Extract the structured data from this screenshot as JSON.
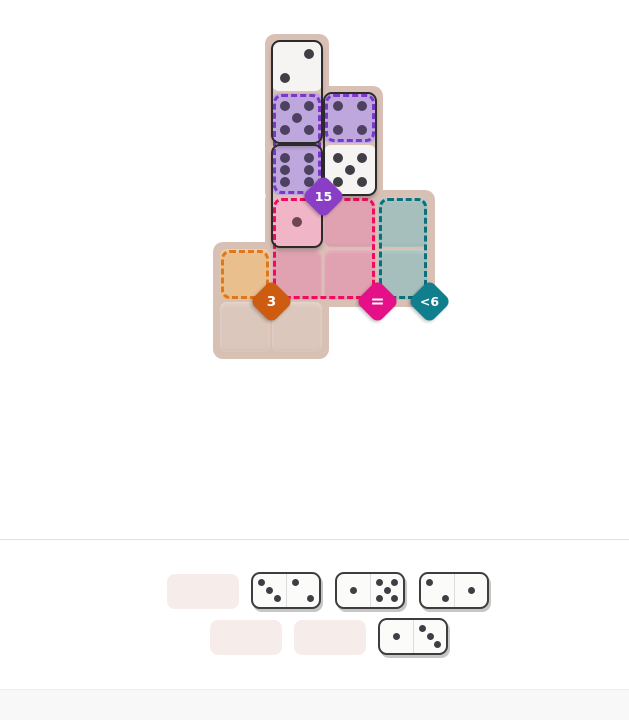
{
  "page": {
    "background": "#ffffff",
    "divider_color": "#e0e0e0",
    "footer_color": "#f8f8f8"
  },
  "palette": {
    "board_bg": "#d8c0b5",
    "cell_free": "#dbc7bc",
    "cell_white": "#f5f4f2",
    "cell_purple": "#bda7dc",
    "cell_pink_filled": "#f0b6c7",
    "cell_pink": "#e0a1b0",
    "cell_teal": "#a6bfbc",
    "cell_orange": "#eabf8e",
    "pip_dark": "#3f3e45",
    "pip_purple": "#4d4060",
    "pip_pink": "#6d4553",
    "domino_outline": "#2b2b2b",
    "tray_slot": "#f6edea",
    "tray_domino_bg": "#fbfbfa"
  },
  "constraints": [
    {
      "id": "sum-15",
      "label": "15",
      "color": "#8a3ec6",
      "border": "#7c36c9",
      "anchor": {
        "gx": 2,
        "gy": 3
      }
    },
    {
      "id": "sum-3",
      "label": "3",
      "color": "#cd5c10",
      "border": "#e1761a",
      "anchor": {
        "gx": 1,
        "gy": 5
      }
    },
    {
      "id": "all-equal",
      "label": "=",
      "color": "#e50f87",
      "border": "#f20a5e",
      "anchor": {
        "gx": 3,
        "gy": 5
      }
    },
    {
      "id": "less-than-6",
      "label": "<6",
      "color": "#0f7f8d",
      "border": "#0b6f7c",
      "anchor": {
        "gx": 4,
        "gy": 5
      }
    }
  ],
  "board": {
    "bg_blocks": [
      {
        "gx": 1,
        "gy": 0,
        "gw": 1,
        "gh": 3
      },
      {
        "gx": 1,
        "gy": 1,
        "gw": 2,
        "gh": 2
      },
      {
        "gx": 1,
        "gy": 3,
        "gw": 3,
        "gh": 2
      },
      {
        "gx": 0,
        "gy": 4,
        "gw": 2,
        "gh": 2
      }
    ],
    "cells": [
      {
        "gx": 1,
        "gy": 0,
        "state": "domino",
        "tint": "white",
        "pips": 2,
        "pip_variant": "2u"
      },
      {
        "gx": 1,
        "gy": 1,
        "state": "domino",
        "tint": "purple",
        "pips": 5
      },
      {
        "gx": 2,
        "gy": 1,
        "state": "domino",
        "tint": "purple",
        "pips": 4
      },
      {
        "gx": 1,
        "gy": 2,
        "state": "domino",
        "tint": "purple",
        "pips": 6
      },
      {
        "gx": 2,
        "gy": 2,
        "state": "domino",
        "tint": "white",
        "pips": 5
      },
      {
        "gx": 1,
        "gy": 3,
        "state": "domino",
        "tint": "pink",
        "pips": 1
      },
      {
        "gx": 2,
        "gy": 3,
        "state": "empty",
        "tint": "pink"
      },
      {
        "gx": 3,
        "gy": 3,
        "state": "empty",
        "tint": "teal"
      },
      {
        "gx": 0,
        "gy": 4,
        "state": "empty",
        "tint": "orange"
      },
      {
        "gx": 1,
        "gy": 4,
        "state": "empty",
        "tint": "pink"
      },
      {
        "gx": 2,
        "gy": 4,
        "state": "empty",
        "tint": "pink"
      },
      {
        "gx": 3,
        "gy": 4,
        "state": "empty",
        "tint": "teal"
      },
      {
        "gx": 0,
        "gy": 5,
        "state": "empty",
        "tint": "free"
      },
      {
        "gx": 1,
        "gy": 5,
        "state": "empty",
        "tint": "free"
      }
    ],
    "dominoes": [
      {
        "gx": 1,
        "gy": 0,
        "gw": 1,
        "gh": 2,
        "values": [
          2,
          5
        ]
      },
      {
        "gx": 2,
        "gy": 1,
        "gw": 1,
        "gh": 2,
        "values": [
          4,
          5
        ]
      },
      {
        "gx": 1,
        "gy": 2,
        "gw": 1,
        "gh": 2,
        "values": [
          6,
          1
        ]
      }
    ],
    "region_outlines": [
      {
        "constraint": 0,
        "gx": 1,
        "gy": 1,
        "gw": 1,
        "gh": 2
      },
      {
        "constraint": 0,
        "gx": 2,
        "gy": 1,
        "gw": 1,
        "gh": 1
      },
      {
        "constraint": 1,
        "gx": 0,
        "gy": 4,
        "gw": 1,
        "gh": 1
      },
      {
        "constraint": 2,
        "gx": 1,
        "gy": 3,
        "gw": 2,
        "gh": 2
      },
      {
        "constraint": 3,
        "gx": 3,
        "gy": 3,
        "gw": 1,
        "gh": 2
      }
    ]
  },
  "tray": {
    "rows": [
      {
        "items": [
          {
            "kind": "slot"
          },
          {
            "kind": "domino",
            "values": [
              3,
              2
            ]
          },
          {
            "kind": "domino",
            "values": [
              1,
              5
            ]
          },
          {
            "kind": "domino",
            "values": [
              2,
              1
            ]
          }
        ]
      },
      {
        "items": [
          {
            "kind": "slot"
          },
          {
            "kind": "slot"
          },
          {
            "kind": "domino",
            "values": [
              1,
              3
            ]
          }
        ]
      }
    ]
  }
}
